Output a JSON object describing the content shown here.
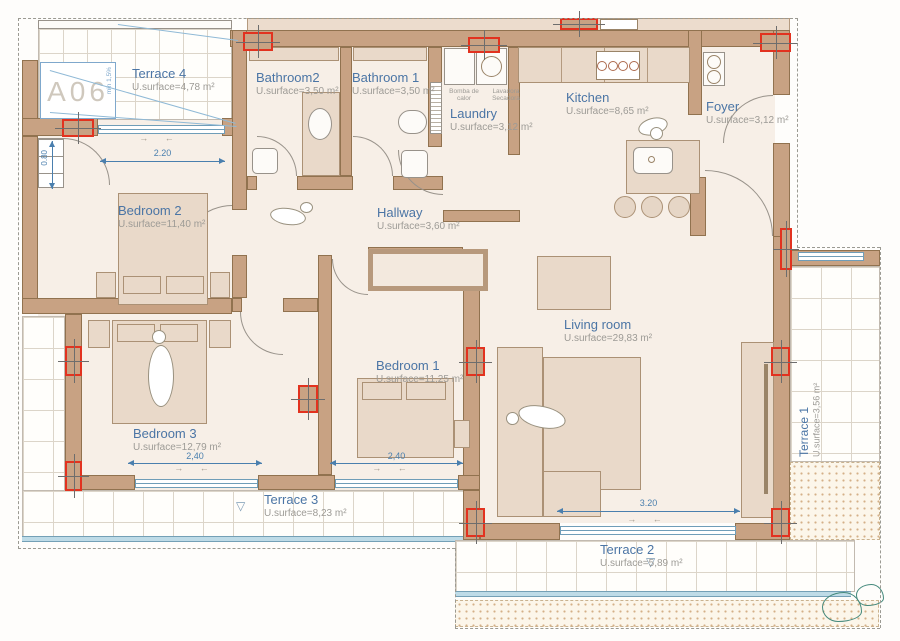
{
  "plan": {
    "unit_label": "A06",
    "slope_note": "min 1,5%",
    "rooms": {
      "terrace4": {
        "name": "Terrace 4",
        "surface": "U.surface=4,78 m²"
      },
      "bathroom2": {
        "name": "Bathroom2",
        "surface": "U.surface=3,50 m²"
      },
      "bathroom1": {
        "name": "Bathroom 1",
        "surface": "U.surface=3,50 m²"
      },
      "laundry": {
        "name": "Laundry",
        "surface": "U.surface=3,12 m²",
        "appliance1": "Bomba de calor",
        "appliance2": "Lavadora Secadora"
      },
      "kitchen": {
        "name": "Kitchen",
        "surface": "U.surface=8,65 m²"
      },
      "foyer": {
        "name": "Foyer",
        "surface": "U.surface=3,12 m²"
      },
      "hallway": {
        "name": "Hallway",
        "surface": "U.surface=3,60 m²"
      },
      "bedroom2": {
        "name": "Bedroom 2",
        "surface": "U.surface=11,40 m²"
      },
      "bedroom1": {
        "name": "Bedroom 1",
        "surface": "U.surface=11,25 m²"
      },
      "bedroom3": {
        "name": "Bedroom 3",
        "surface": "U.surface=12,79 m²"
      },
      "living": {
        "name": "Living room",
        "surface": "U.surface=29,83 m²"
      },
      "terrace3": {
        "name": "Terrace 3",
        "surface": "U.surface=8,23 m²"
      },
      "terrace2": {
        "name": "Terrace 2",
        "surface": "U.surface=5,89 m²"
      },
      "terrace1": {
        "name": "Terrace 1",
        "surface": "U.surface=3,56 m²"
      }
    },
    "dimensions": {
      "terrace4_window": "2.20",
      "bedroom2_closet": "0.80",
      "bedroom3_window": "2,40",
      "bedroom1_window": "2,40",
      "living_window": "3.20"
    },
    "marks": {
      "open_arrows": "→ ←",
      "level_triangle": "▽"
    },
    "colors": {
      "wall": "#c8a283",
      "label_blue": "#4b75a5",
      "dimension_blue": "#4a7fae",
      "column_red": "#e2321f",
      "window_blue": "#6f9db8"
    }
  }
}
